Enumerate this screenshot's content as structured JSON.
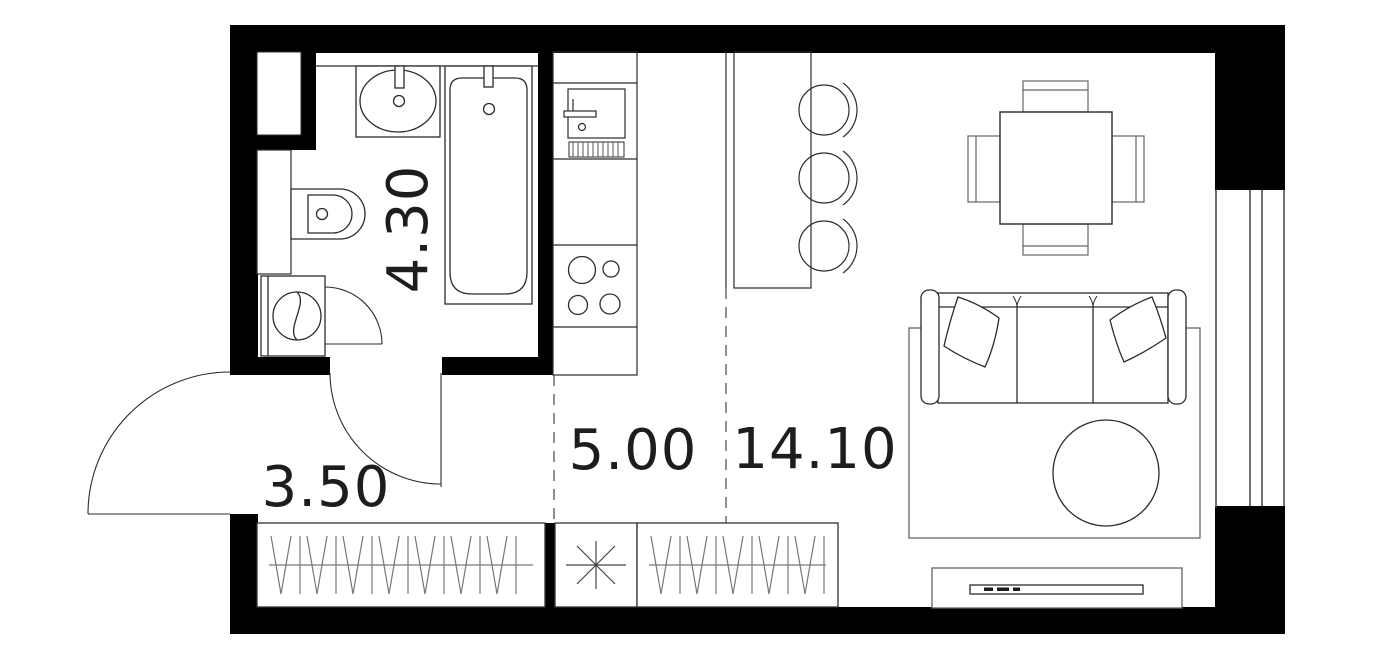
{
  "plan": {
    "title": "studio-apartment-floor-plan",
    "rooms": [
      {
        "id": "bathroom",
        "area_label": "4.30",
        "rotated": true
      },
      {
        "id": "hallway",
        "area_label": "3.50",
        "rotated": false
      },
      {
        "id": "kitchen",
        "area_label": "5.00",
        "rotated": false
      },
      {
        "id": "living-room",
        "area_label": "14.10",
        "rotated": false
      }
    ],
    "colors": {
      "wall": "#000000",
      "fixture_line": "#2b2b2b",
      "light_line": "#777777",
      "dashed_line": "#555555",
      "background": "#ffffff",
      "label_text": "#1d1d1d"
    },
    "fixtures": [
      "washbasin",
      "bathtub",
      "toilet",
      "washing-machine",
      "ventilation-shaft",
      "bathroom-door",
      "closet-door",
      "entrance-door",
      "kitchen-counter",
      "kitchen-sink",
      "dish-drainer",
      "stove-4-burners",
      "bar-counter",
      "bar-stools-3",
      "wardrobe-hangers-left",
      "washer-place-asterisk",
      "wardrobe-hangers-right",
      "dining-table",
      "dining-chairs-4",
      "sofa-3-seat",
      "pillows-2",
      "rug",
      "coffee-table-round",
      "tv-stand",
      "window-right"
    ]
  }
}
